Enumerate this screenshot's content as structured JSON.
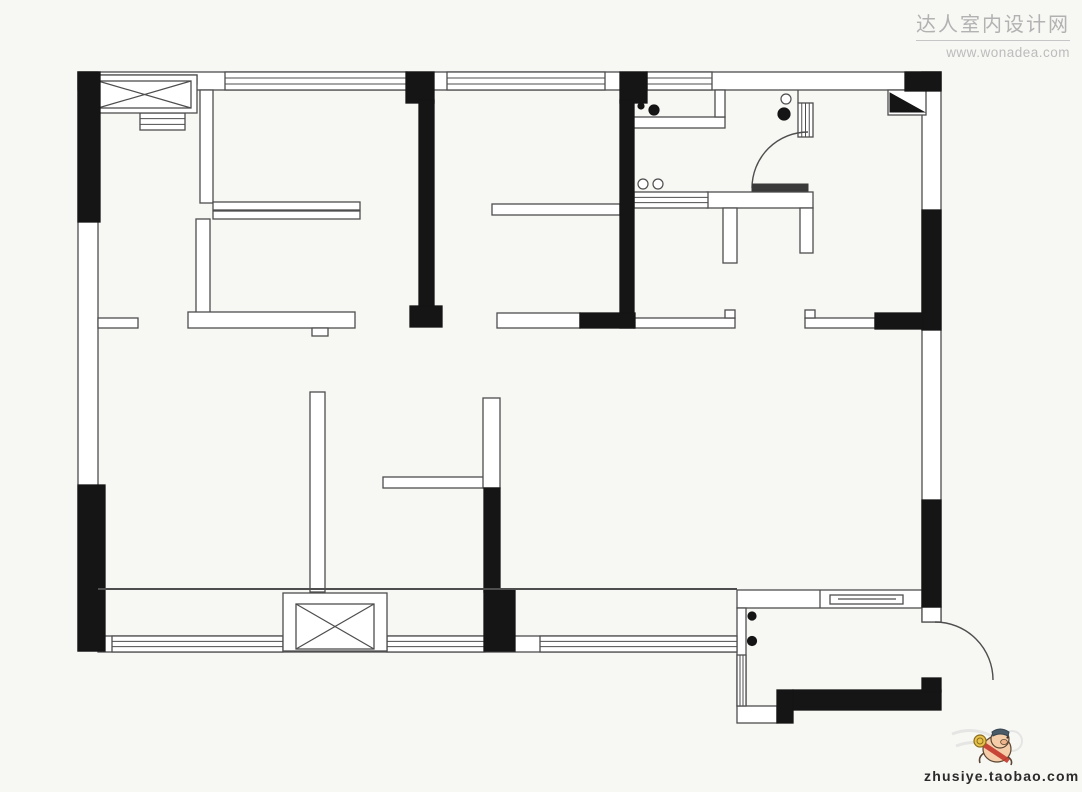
{
  "page": {
    "background": "#f7f7f4"
  },
  "watermark": {
    "site_name": "达人室内设计网",
    "site_url": "www.wonadea.com"
  },
  "footer": {
    "shop_url": "zhusiye.taobao.com",
    "mascot": "pig-mascot-icon"
  },
  "plan": {
    "colors": {
      "wall": "#151515",
      "line": "#4e4e4e",
      "fill": "#ffffff",
      "gray": "#cdcdcd",
      "leaf": "#3a3a3a"
    },
    "rects": [
      {
        "name": "outer-wall-top",
        "x": 78,
        "y": 72,
        "w": 863,
        "h": 18
      },
      {
        "name": "outer-wall-left",
        "x": 78,
        "y": 72,
        "w": 20,
        "h": 579
      },
      {
        "name": "outer-wall-right",
        "x": 922,
        "y": 72,
        "w": 19,
        "h": 550
      },
      {
        "name": "outer-wall-bottom",
        "x": 98,
        "y": 636,
        "w": 647,
        "h": 16
      },
      {
        "name": "bedroom1-partition",
        "x": 200,
        "y": 90,
        "w": 13,
        "h": 113
      },
      {
        "name": "wardrobe-bar-1",
        "x": 213,
        "y": 202,
        "w": 147,
        "h": 8
      },
      {
        "name": "wardrobe-bar-2",
        "x": 213,
        "y": 211,
        "w": 147,
        "h": 8
      },
      {
        "name": "living-wall-stub-left",
        "x": 98,
        "y": 318,
        "w": 40,
        "h": 10
      },
      {
        "name": "bedroom1-wall-vertical",
        "x": 196,
        "y": 219,
        "w": 14,
        "h": 95
      },
      {
        "name": "bedroom1-wall-bottom",
        "x": 188,
        "y": 312,
        "w": 167,
        "h": 16
      },
      {
        "name": "bedroom1-wall-notch",
        "x": 312,
        "y": 328,
        "w": 16,
        "h": 8
      },
      {
        "name": "bedroom2-wall-bottom",
        "x": 497,
        "y": 313,
        "w": 83,
        "h": 15
      },
      {
        "name": "hallway-wall-top",
        "x": 492,
        "y": 204,
        "w": 128,
        "h": 11
      },
      {
        "name": "hallway-wall-bottom-left",
        "x": 634,
        "y": 318,
        "w": 101,
        "h": 10
      },
      {
        "name": "hallway-wall-lip-1",
        "x": 725,
        "y": 310,
        "w": 10,
        "h": 8
      },
      {
        "name": "hallway-wall-bottom-right",
        "x": 805,
        "y": 318,
        "w": 70,
        "h": 10
      },
      {
        "name": "hallway-wall-lip-2",
        "x": 805,
        "y": 310,
        "w": 10,
        "h": 8
      },
      {
        "name": "living-partition-vertical",
        "x": 310,
        "y": 392,
        "w": 15,
        "h": 200
      },
      {
        "name": "living-partition-horizontal",
        "x": 383,
        "y": 477,
        "w": 102,
        "h": 11
      },
      {
        "name": "living-partition-upper",
        "x": 483,
        "y": 398,
        "w": 17,
        "h": 90
      },
      {
        "name": "entry-wall-top",
        "x": 737,
        "y": 590,
        "w": 185,
        "h": 18
      },
      {
        "name": "entry-wall-left",
        "x": 737,
        "y": 608,
        "w": 9,
        "h": 98
      },
      {
        "name": "entry-box-bottom-left",
        "x": 737,
        "y": 706,
        "w": 40,
        "h": 17
      },
      {
        "name": "entry-door-jamb-box",
        "x": 922,
        "y": 607,
        "w": 19,
        "h": 15
      },
      {
        "name": "kitchen-counter",
        "x": 633,
        "y": 117,
        "w": 92,
        "h": 11
      },
      {
        "name": "kitchen-counter-return",
        "x": 715,
        "y": 90,
        "w": 10,
        "h": 27
      },
      {
        "name": "dining-table-top",
        "x": 707,
        "y": 192,
        "w": 106,
        "h": 16
      },
      {
        "name": "dining-table-leg-left",
        "x": 723,
        "y": 208,
        "w": 14,
        "h": 55
      },
      {
        "name": "dining-table-leg-right",
        "x": 800,
        "y": 208,
        "w": 13,
        "h": 45
      },
      {
        "name": "shoe-cabinet",
        "x": 830,
        "y": 595,
        "w": 73,
        "h": 9
      },
      {
        "name": "bathroom-corner-shelf-frame",
        "x": 888,
        "y": 90,
        "w": 38,
        "h": 25
      }
    ],
    "black_rects": [
      {
        "name": "wall-black-left-upper",
        "x": 78,
        "y": 72,
        "w": 22,
        "h": 150
      },
      {
        "name": "wall-black-left-lower",
        "x": 78,
        "y": 485,
        "w": 27,
        "h": 166
      },
      {
        "name": "pier-top-1",
        "x": 406,
        "y": 72,
        "w": 28,
        "h": 31
      },
      {
        "name": "wall-black-bedroom1",
        "x": 419,
        "y": 100,
        "w": 15,
        "h": 210
      },
      {
        "name": "wall-black-bedroom1-foot",
        "x": 410,
        "y": 306,
        "w": 32,
        "h": 21
      },
      {
        "name": "pier-top-2",
        "x": 620,
        "y": 72,
        "w": 27,
        "h": 31
      },
      {
        "name": "wall-black-bedroom2",
        "x": 620,
        "y": 100,
        "w": 14,
        "h": 228
      },
      {
        "name": "wall-black-bedroom2-foot",
        "x": 580,
        "y": 313,
        "w": 55,
        "h": 15
      },
      {
        "name": "wall-black-corner-tr",
        "x": 905,
        "y": 72,
        "w": 36,
        "h": 19
      },
      {
        "name": "wall-black-right-upper",
        "x": 922,
        "y": 210,
        "w": 19,
        "h": 120
      },
      {
        "name": "wall-black-hall-right",
        "x": 875,
        "y": 313,
        "w": 48,
        "h": 16
      },
      {
        "name": "wall-black-right-lower",
        "x": 922,
        "y": 500,
        "w": 19,
        "h": 107
      },
      {
        "name": "wall-black-living-divider",
        "x": 484,
        "y": 488,
        "w": 16,
        "h": 104
      },
      {
        "name": "wall-black-living-divider-foot",
        "x": 484,
        "y": 590,
        "w": 31,
        "h": 61
      },
      {
        "name": "entry-wall-black-bottom",
        "x": 793,
        "y": 690,
        "w": 148,
        "h": 20
      },
      {
        "name": "entry-wall-black-step",
        "x": 922,
        "y": 678,
        "w": 19,
        "h": 14
      },
      {
        "name": "entry-wall-black-corner",
        "x": 777,
        "y": 690,
        "w": 16,
        "h": 33
      }
    ],
    "gray_rects": [
      {
        "name": "shaft-top-strip",
        "x": 92,
        "y": 75,
        "w": 105,
        "h": 9
      }
    ],
    "windows": [
      {
        "name": "window-top-1",
        "x": 225,
        "y": 72,
        "w": 182,
        "h": 18,
        "orient": "h"
      },
      {
        "name": "window-top-2",
        "x": 447,
        "y": 72,
        "w": 158,
        "h": 18,
        "orient": "h"
      },
      {
        "name": "window-top-3",
        "x": 647,
        "y": 72,
        "w": 65,
        "h": 18,
        "orient": "h"
      },
      {
        "name": "window-bottom-1",
        "x": 112,
        "y": 636,
        "w": 171,
        "h": 16,
        "orient": "h"
      },
      {
        "name": "window-bottom-2",
        "x": 387,
        "y": 636,
        "w": 98,
        "h": 16,
        "orient": "h"
      },
      {
        "name": "window-bottom-3",
        "x": 540,
        "y": 636,
        "w": 197,
        "h": 16,
        "orient": "h"
      },
      {
        "name": "window-entry-left",
        "x": 737,
        "y": 655,
        "w": 9,
        "h": 51,
        "orient": "v"
      }
    ],
    "lined_blocks": [
      {
        "name": "duct-grille",
        "x": 140,
        "y": 113,
        "w": 45,
        "h": 17,
        "orient": "h"
      },
      {
        "name": "kitchen-pass-grille",
        "x": 634,
        "y": 192,
        "w": 74,
        "h": 16,
        "orient": "h"
      },
      {
        "name": "bathroom-door-jamb",
        "x": 798,
        "y": 103,
        "w": 15,
        "h": 34,
        "orient": "v"
      }
    ],
    "xboxes": [
      {
        "name": "shaft-top-left",
        "x": 92,
        "y": 75,
        "w": 105,
        "h": 38,
        "ix": 98,
        "iy": 81,
        "iw": 93,
        "ih": 27
      },
      {
        "name": "shaft-bottom",
        "x": 283,
        "y": 593,
        "w": 104,
        "h": 58,
        "ix": 296,
        "iy": 604,
        "iw": 78,
        "ih": 45
      }
    ],
    "lines": [
      {
        "name": "balcony-track-line",
        "x1": 98,
        "y1": 589,
        "x2": 737,
        "y2": 589,
        "sw": 2
      },
      {
        "name": "entry-wall-divider",
        "x1": 820,
        "y1": 590,
        "x2": 820,
        "y2": 608,
        "sw": 1.3
      },
      {
        "name": "bathroom-jamb-stem",
        "x1": 798,
        "y1": 90,
        "x2": 798,
        "y2": 103,
        "sw": 1.3
      },
      {
        "name": "shoe-cabinet-inner-line",
        "x1": 838,
        "y1": 599,
        "x2": 896,
        "y2": 599,
        "sw": 1.3
      }
    ],
    "circles": [
      {
        "name": "stove-burner-small",
        "cx": 641,
        "cy": 106,
        "r": 3,
        "filled": true
      },
      {
        "name": "stove-burner-large",
        "cx": 654,
        "cy": 110,
        "r": 5,
        "filled": true
      },
      {
        "name": "sink-bowl-left",
        "cx": 643,
        "cy": 184,
        "r": 5,
        "filled": false
      },
      {
        "name": "sink-bowl-right",
        "cx": 658,
        "cy": 184,
        "r": 5,
        "filled": false
      },
      {
        "name": "bathroom-fixture-small",
        "cx": 786,
        "cy": 99,
        "r": 5,
        "filled": false
      },
      {
        "name": "bathroom-fixture-large",
        "cx": 784,
        "cy": 114,
        "r": 6,
        "filled": true
      },
      {
        "name": "entry-fixture-1",
        "cx": 752,
        "cy": 616,
        "r": 4,
        "filled": true
      },
      {
        "name": "entry-fixture-2",
        "cx": 752,
        "cy": 641,
        "r": 4.5,
        "filled": true
      }
    ],
    "arcs": [
      {
        "name": "bathroom-door-arc",
        "sx": 752,
        "sy": 188,
        "r": 56,
        "ex": 808,
        "ey": 132
      },
      {
        "name": "entry-door-arc",
        "sx": 935,
        "sy": 622,
        "r": 58,
        "ex": 993,
        "ey": 680
      }
    ],
    "leafs": [
      {
        "name": "bathroom-door-leaf",
        "x": 752,
        "y": 184,
        "w": 56,
        "h": 7
      }
    ],
    "polygons": [
      {
        "name": "bathroom-corner-shelf",
        "points": "890,93 924,112 890,112"
      }
    ]
  }
}
